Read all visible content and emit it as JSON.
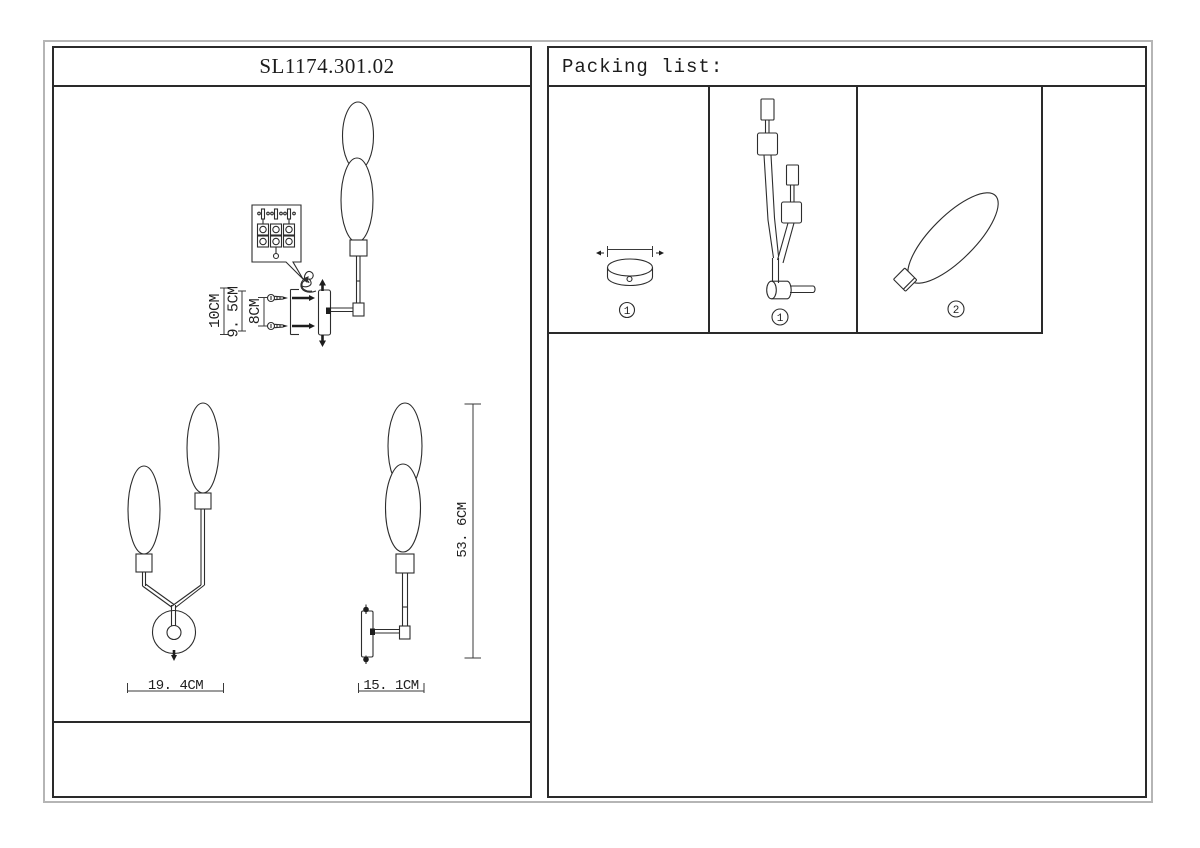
{
  "sheet": {
    "model": "SL1174.301.02",
    "packing_header": "Packing list:"
  },
  "install_diagram": {
    "dim_labels": [
      "10CM",
      "9. 5CM",
      "8CM"
    ],
    "icons": [
      "up-arrow",
      "down-arrow",
      "wall-screw",
      "mounting-bracket",
      "terminal-block-callout"
    ]
  },
  "front_view": {
    "width_label": "19. 4CM"
  },
  "side_view": {
    "width_label": "15. 1CM",
    "height_label": "53. 6CM"
  },
  "packing_list": {
    "items": [
      {
        "part": "round-ceiling-canopy",
        "qty_label": "1"
      },
      {
        "part": "double-arm-wall-fixture",
        "qty_label": "1"
      },
      {
        "part": "oval-glass-shade",
        "qty_label": "2"
      }
    ]
  },
  "colors": {
    "line": "#2d2d2d",
    "panel_border": "#2a2a2a",
    "sheet_border": "#b5b5b5",
    "background": "#ffffff"
  }
}
